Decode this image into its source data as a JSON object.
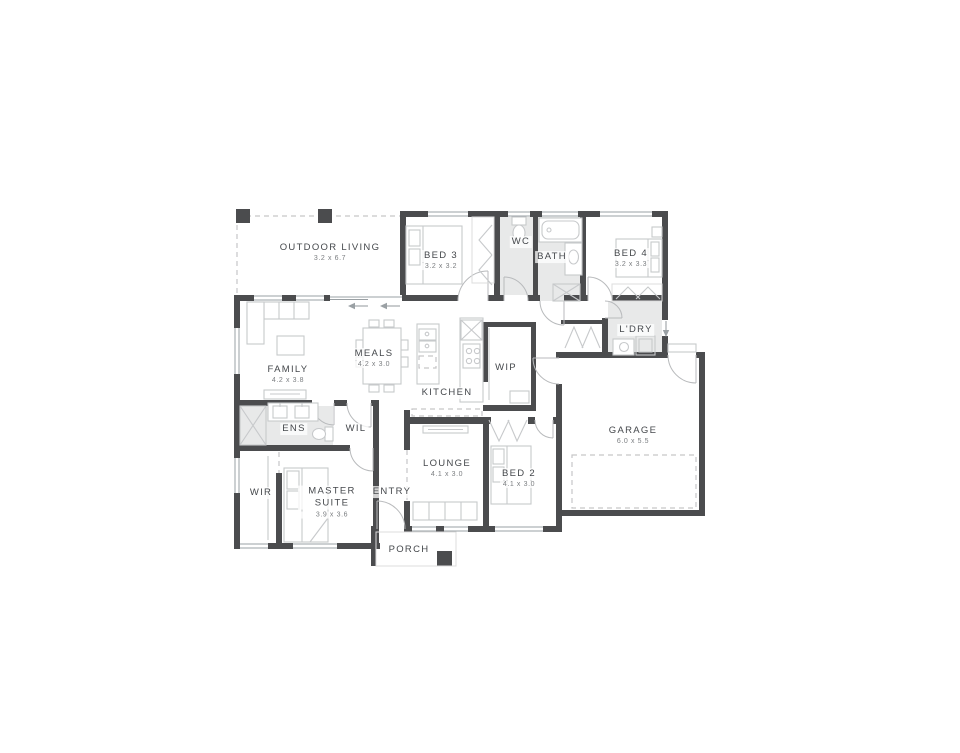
{
  "plan": {
    "rooms": [
      {
        "id": "outdoor-living",
        "name": "OUTDOOR LIVING",
        "dims": "3.2 x 6.7"
      },
      {
        "id": "bed3",
        "name": "BED 3",
        "dims": "3.2 x 3.2"
      },
      {
        "id": "wc",
        "name": "WC",
        "dims": ""
      },
      {
        "id": "bath",
        "name": "BATH",
        "dims": ""
      },
      {
        "id": "bed4",
        "name": "BED 4",
        "dims": "3.2 x 3.3"
      },
      {
        "id": "ldry",
        "name": "L'DRY",
        "dims": ""
      },
      {
        "id": "family",
        "name": "FAMILY",
        "dims": "4.2 x 3.8"
      },
      {
        "id": "meals",
        "name": "MEALS",
        "dims": "4.2 x 3.0"
      },
      {
        "id": "kitchen",
        "name": "KITCHEN",
        "dims": ""
      },
      {
        "id": "wip",
        "name": "WIP",
        "dims": ""
      },
      {
        "id": "ens",
        "name": "ENS",
        "dims": ""
      },
      {
        "id": "wil",
        "name": "WIL",
        "dims": ""
      },
      {
        "id": "wir",
        "name": "WIR",
        "dims": ""
      },
      {
        "id": "master",
        "name": "MASTER SUITE",
        "dims": "3.9 x 3.6"
      },
      {
        "id": "entry",
        "name": "ENTRY",
        "dims": ""
      },
      {
        "id": "lounge",
        "name": "LOUNGE",
        "dims": "4.1 x 3.0"
      },
      {
        "id": "bed2",
        "name": "BED 2",
        "dims": "4.1 x 3.0"
      },
      {
        "id": "garage",
        "name": "GARAGE",
        "dims": "6.0 x 5.5"
      },
      {
        "id": "porch",
        "name": "PORCH",
        "dims": ""
      }
    ],
    "colors": {
      "wall": "#4b4c4e",
      "wet_fill": "#e8e9e9",
      "furniture_line": "#c7c9cb",
      "label": "#45484c",
      "dims": "#7b7e81",
      "background": "#ffffff"
    }
  }
}
